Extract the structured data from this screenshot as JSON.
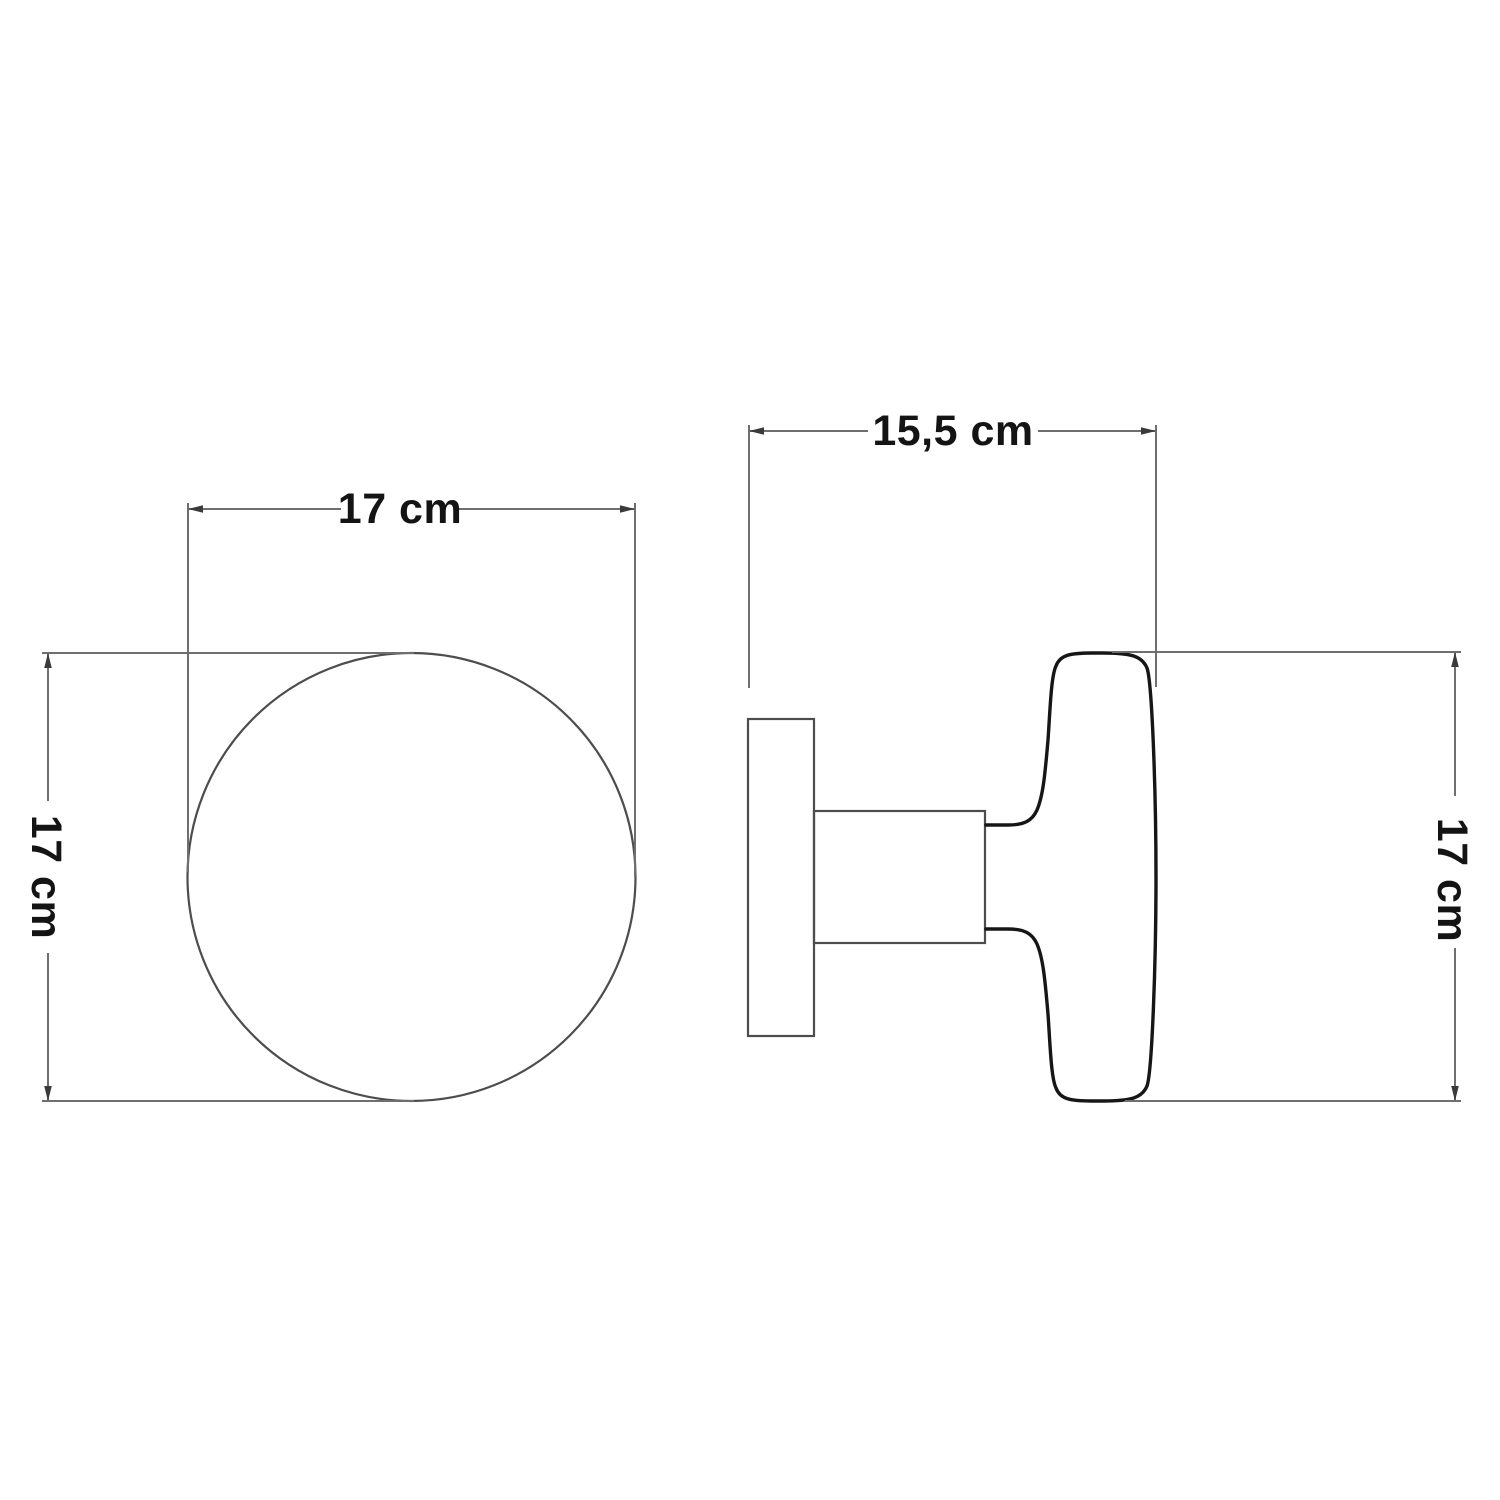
{
  "drawing": {
    "description": "Technical dimension drawing of a round knob / wall lamp, front view and side view",
    "views": {
      "front": {
        "name": "front-view",
        "width_label": "17 cm",
        "height_label": "17 cm"
      },
      "side": {
        "name": "side-view",
        "width_label": "15,5 cm",
        "height_label": "17 cm"
      }
    },
    "colors": {
      "background": "#ffffff",
      "dimension_line": "#6f6f6f",
      "arrowhead": "#3a3a3a",
      "thin_outline": "#4d4d4d",
      "bold_outline": "#161616",
      "text": "#141414"
    }
  }
}
